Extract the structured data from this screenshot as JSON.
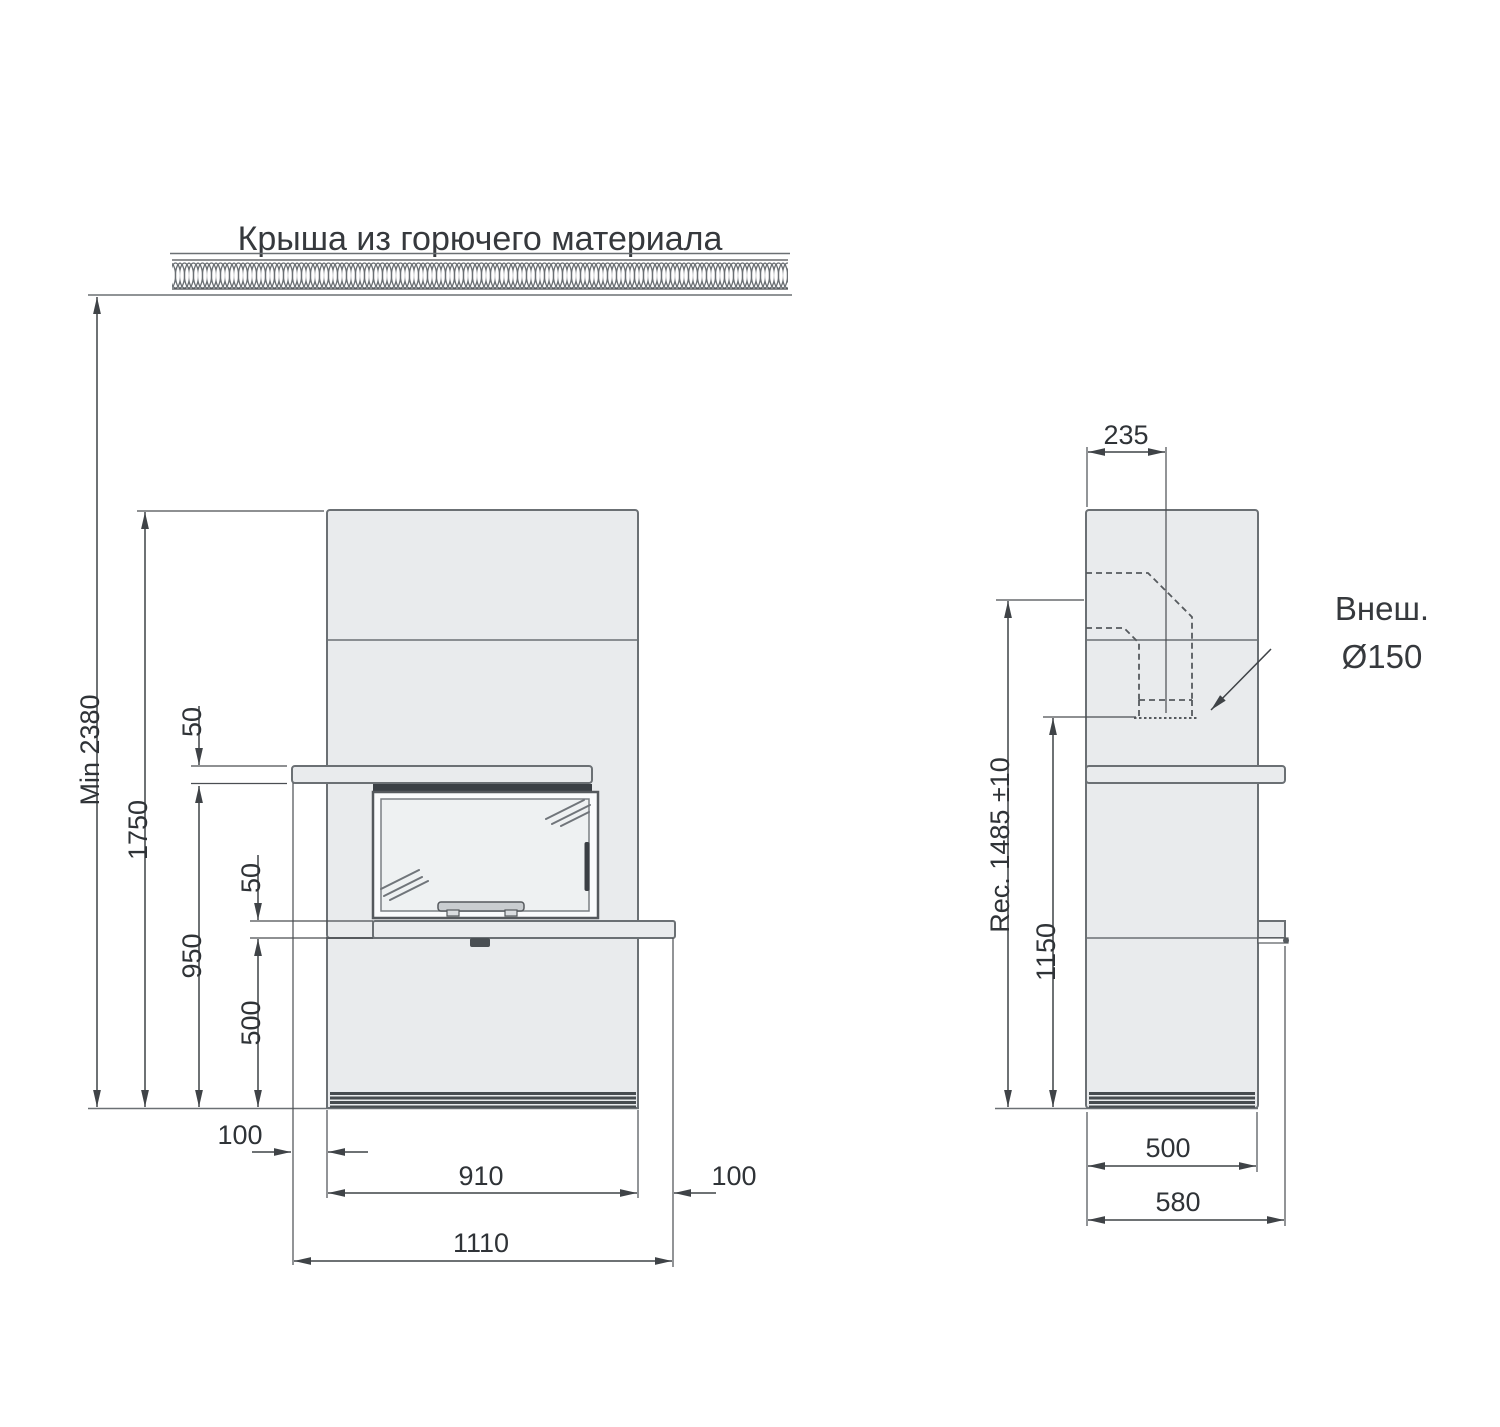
{
  "title": "Крыша из горючего материала",
  "front_view": {
    "min_ceiling_height": "Min 2380",
    "body_height": "1750",
    "mantel_thickness": "50",
    "mantel_underside_height": "950",
    "hearth_thickness": "50",
    "base_height": "500",
    "left_overhang": "100",
    "body_width": "910",
    "right_overhang": "100",
    "total_width": "1110"
  },
  "side_view": {
    "flue_center_offset": "235",
    "recommended_flue_height": "Rec. 1485 ±10",
    "flue_bottom_height": "1150",
    "body_depth": "500",
    "total_depth": "580",
    "flue_label_line1": "Внеш.",
    "flue_label_line2": "Ø150"
  },
  "colors": {
    "body_fill": "#e9ebed",
    "outline": "#6b7074",
    "dim_line": "#3f4347",
    "dark_detail": "#3a3f44"
  }
}
